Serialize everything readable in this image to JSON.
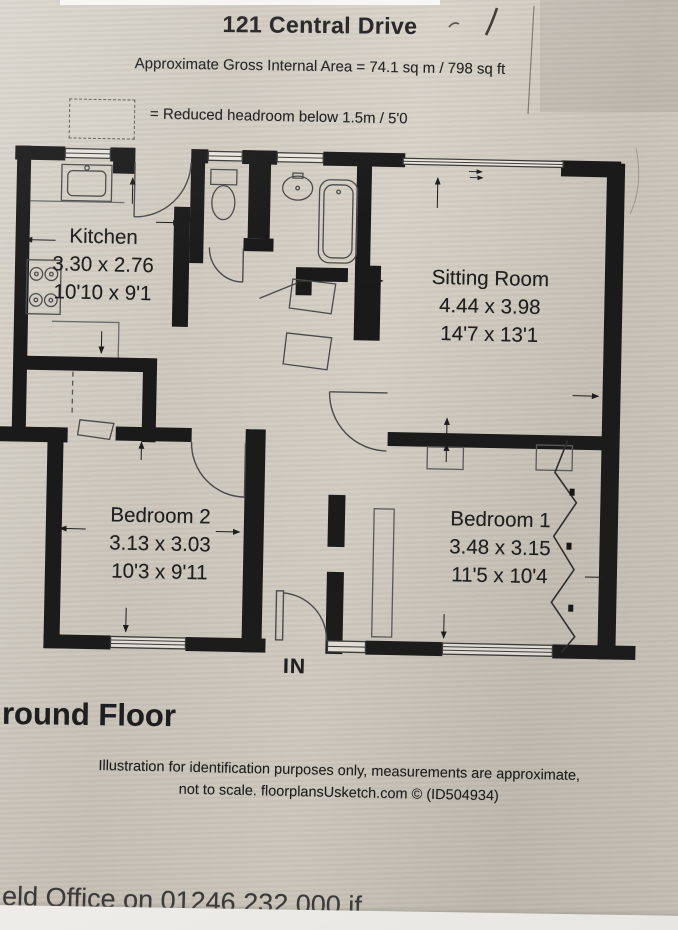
{
  "photo": {
    "paper_color": "#d2ccc3",
    "ink_color": "#1a1a1a",
    "bottom_band_color": "#fbfaf6"
  },
  "header": {
    "title": "121 Central Drive",
    "area_line": "Approximate Gross Internal Area = 74.1 sq m / 798 sq ft"
  },
  "legend": {
    "swatch": "dashed-rectangle",
    "text": "= Reduced headroom below 1.5m / 5'0"
  },
  "floorplan": {
    "rooms": [
      {
        "name": "Kitchen",
        "metric": "3.30 x 2.76",
        "imperial": "10'10 x 9'1"
      },
      {
        "name": "Sitting Room",
        "metric": "4.44 x 3.98",
        "imperial": "14'7 x 13'1"
      },
      {
        "name": "Bedroom 2",
        "metric": "3.13 x 3.03",
        "imperial": "10'3 x 9'11"
      },
      {
        "name": "Bedroom 1",
        "metric": "3.48 x 3.15",
        "imperial": "11'5 x 10'4"
      }
    ],
    "entrance_label": "IN",
    "symbols": [
      "hob-icon",
      "sink-icon",
      "toilet-icon",
      "basin-icon",
      "bath-icon",
      "wardrobe-icon",
      "cupboard-door-icon",
      "door-arc",
      "window",
      "zigzag-wall-mark",
      "dimension-arrow",
      "entrance-door"
    ]
  },
  "annotations": {
    "pen_marks": [
      "slash-pen-mark",
      "crease-line"
    ]
  },
  "footer": {
    "floor_label": "round Floor",
    "disclaimer_line1": "Illustration for identification purposes only, measurements are approximate,",
    "disclaimer_line2": "not to scale. floorplansUsketch.com © (ID504934)",
    "cut_off_text": "eld Office on 01246 232 000 if"
  }
}
